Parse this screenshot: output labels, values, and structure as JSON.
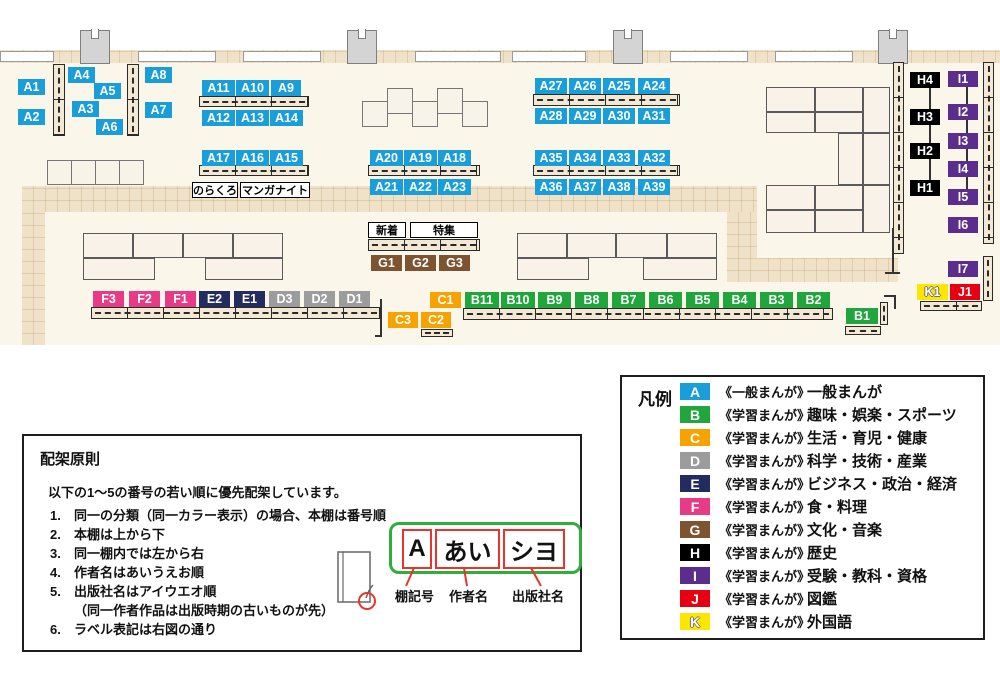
{
  "palette": {
    "A": {
      "bg": "#1a9ed9",
      "fg": "#ffffff"
    },
    "B": {
      "bg": "#21a63d",
      "fg": "#ffffff"
    },
    "C": {
      "bg": "#f6a200",
      "fg": "#ffffff"
    },
    "D": {
      "bg": "#9c9c9c",
      "fg": "#ffffff"
    },
    "E": {
      "bg": "#222c5e",
      "fg": "#ffffff"
    },
    "F": {
      "bg": "#e73b85",
      "fg": "#ffffff"
    },
    "G": {
      "bg": "#7d5330",
      "fg": "#ffffff"
    },
    "H": {
      "bg": "#000000",
      "fg": "#ffffff"
    },
    "I": {
      "bg": "#5b2d8d",
      "fg": "#ffffff"
    },
    "J": {
      "bg": "#e60012",
      "fg": "#ffffff"
    },
    "K": {
      "bg": "#ffe600",
      "fg": "#ffffff"
    }
  },
  "map": {
    "shelf_labels": [
      {
        "t": "A1",
        "c": "A",
        "x": 18,
        "y": 79,
        "w": 27
      },
      {
        "t": "A2",
        "c": "A",
        "x": 18,
        "y": 109,
        "w": 27
      },
      {
        "t": "A4",
        "c": "A",
        "x": 68,
        "y": 67,
        "w": 27
      },
      {
        "t": "A5",
        "c": "A",
        "x": 94,
        "y": 83,
        "w": 27
      },
      {
        "t": "A3",
        "c": "A",
        "x": 72,
        "y": 101,
        "w": 27
      },
      {
        "t": "A6",
        "c": "A",
        "x": 96,
        "y": 119,
        "w": 27
      },
      {
        "t": "A8",
        "c": "A",
        "x": 145,
        "y": 67,
        "w": 27
      },
      {
        "t": "A7",
        "c": "A",
        "x": 145,
        "y": 102,
        "w": 27
      },
      {
        "t": "A11",
        "c": "A",
        "x": 202,
        "y": 80,
        "w": 33
      },
      {
        "t": "A10",
        "c": "A",
        "x": 236,
        "y": 80,
        "w": 33
      },
      {
        "t": "A9",
        "c": "A",
        "x": 271,
        "y": 80,
        "w": 30
      },
      {
        "t": "A12",
        "c": "A",
        "x": 202,
        "y": 110,
        "w": 33
      },
      {
        "t": "A13",
        "c": "A",
        "x": 236,
        "y": 110,
        "w": 33
      },
      {
        "t": "A14",
        "c": "A",
        "x": 270,
        "y": 110,
        "w": 33
      },
      {
        "t": "A17",
        "c": "A",
        "x": 202,
        "y": 150,
        "w": 33
      },
      {
        "t": "A16",
        "c": "A",
        "x": 236,
        "y": 150,
        "w": 33
      },
      {
        "t": "A15",
        "c": "A",
        "x": 270,
        "y": 150,
        "w": 33
      },
      {
        "t": "A20",
        "c": "A",
        "x": 370,
        "y": 150,
        "w": 33
      },
      {
        "t": "A19",
        "c": "A",
        "x": 404,
        "y": 150,
        "w": 33
      },
      {
        "t": "A18",
        "c": "A",
        "x": 438,
        "y": 150,
        "w": 33
      },
      {
        "t": "A21",
        "c": "A",
        "x": 370,
        "y": 179,
        "w": 33
      },
      {
        "t": "A22",
        "c": "A",
        "x": 404,
        "y": 179,
        "w": 33
      },
      {
        "t": "A23",
        "c": "A",
        "x": 438,
        "y": 179,
        "w": 33
      },
      {
        "t": "A27",
        "c": "A",
        "x": 535,
        "y": 78,
        "w": 32
      },
      {
        "t": "A26",
        "c": "A",
        "x": 569,
        "y": 78,
        "w": 32
      },
      {
        "t": "A25",
        "c": "A",
        "x": 603,
        "y": 78,
        "w": 32
      },
      {
        "t": "A24",
        "c": "A",
        "x": 638,
        "y": 78,
        "w": 32
      },
      {
        "t": "A28",
        "c": "A",
        "x": 535,
        "y": 108,
        "w": 32
      },
      {
        "t": "A29",
        "c": "A",
        "x": 569,
        "y": 108,
        "w": 32
      },
      {
        "t": "A30",
        "c": "A",
        "x": 603,
        "y": 108,
        "w": 32
      },
      {
        "t": "A31",
        "c": "A",
        "x": 638,
        "y": 108,
        "w": 32
      },
      {
        "t": "A35",
        "c": "A",
        "x": 535,
        "y": 150,
        "w": 32
      },
      {
        "t": "A34",
        "c": "A",
        "x": 569,
        "y": 150,
        "w": 32
      },
      {
        "t": "A33",
        "c": "A",
        "x": 603,
        "y": 150,
        "w": 32
      },
      {
        "t": "A32",
        "c": "A",
        "x": 638,
        "y": 150,
        "w": 32
      },
      {
        "t": "A36",
        "c": "A",
        "x": 535,
        "y": 179,
        "w": 32
      },
      {
        "t": "A37",
        "c": "A",
        "x": 569,
        "y": 179,
        "w": 32
      },
      {
        "t": "A38",
        "c": "A",
        "x": 603,
        "y": 179,
        "w": 32
      },
      {
        "t": "A39",
        "c": "A",
        "x": 638,
        "y": 179,
        "w": 32
      },
      {
        "t": "G1",
        "c": "G",
        "x": 371,
        "y": 255,
        "w": 31
      },
      {
        "t": "G2",
        "c": "G",
        "x": 405,
        "y": 255,
        "w": 31
      },
      {
        "t": "G3",
        "c": "G",
        "x": 439,
        "y": 255,
        "w": 31
      },
      {
        "t": "F3",
        "c": "F",
        "x": 93,
        "y": 291,
        "w": 31
      },
      {
        "t": "F2",
        "c": "F",
        "x": 129,
        "y": 291,
        "w": 31
      },
      {
        "t": "F1",
        "c": "F",
        "x": 165,
        "y": 291,
        "w": 31
      },
      {
        "t": "E2",
        "c": "E",
        "x": 199,
        "y": 291,
        "w": 31
      },
      {
        "t": "E1",
        "c": "E",
        "x": 234,
        "y": 291,
        "w": 31
      },
      {
        "t": "D3",
        "c": "D",
        "x": 269,
        "y": 291,
        "w": 31
      },
      {
        "t": "D2",
        "c": "D",
        "x": 304,
        "y": 291,
        "w": 31
      },
      {
        "t": "D1",
        "c": "D",
        "x": 339,
        "y": 291,
        "w": 31
      },
      {
        "t": "C1",
        "c": "C",
        "x": 430,
        "y": 292,
        "w": 31
      },
      {
        "t": "C3",
        "c": "C",
        "x": 388,
        "y": 312,
        "w": 30
      },
      {
        "t": "C2",
        "c": "C",
        "x": 421,
        "y": 312,
        "w": 30
      },
      {
        "t": "B11",
        "c": "B",
        "x": 465,
        "y": 292,
        "w": 34
      },
      {
        "t": "B10",
        "c": "B",
        "x": 501,
        "y": 292,
        "w": 34
      },
      {
        "t": "B9",
        "c": "B",
        "x": 538,
        "y": 292,
        "w": 33
      },
      {
        "t": "B8",
        "c": "B",
        "x": 575,
        "y": 292,
        "w": 33
      },
      {
        "t": "B7",
        "c": "B",
        "x": 612,
        "y": 292,
        "w": 33
      },
      {
        "t": "B6",
        "c": "B",
        "x": 649,
        "y": 292,
        "w": 33
      },
      {
        "t": "B5",
        "c": "B",
        "x": 686,
        "y": 292,
        "w": 33
      },
      {
        "t": "B4",
        "c": "B",
        "x": 723,
        "y": 292,
        "w": 33
      },
      {
        "t": "B3",
        "c": "B",
        "x": 760,
        "y": 292,
        "w": 33
      },
      {
        "t": "B2",
        "c": "B",
        "x": 797,
        "y": 292,
        "w": 33
      },
      {
        "t": "B1",
        "c": "B",
        "x": 846,
        "y": 308,
        "w": 32
      },
      {
        "t": "H4",
        "c": "H",
        "x": 910,
        "y": 72,
        "w": 30
      },
      {
        "t": "H3",
        "c": "H",
        "x": 910,
        "y": 109,
        "w": 30
      },
      {
        "t": "H2",
        "c": "H",
        "x": 910,
        "y": 143,
        "w": 30
      },
      {
        "t": "H1",
        "c": "H",
        "x": 910,
        "y": 180,
        "w": 30
      },
      {
        "t": "I1",
        "c": "I",
        "x": 948,
        "y": 71,
        "w": 30
      },
      {
        "t": "I2",
        "c": "I",
        "x": 948,
        "y": 104,
        "w": 30
      },
      {
        "t": "I3",
        "c": "I",
        "x": 948,
        "y": 133,
        "w": 30
      },
      {
        "t": "I4",
        "c": "I",
        "x": 948,
        "y": 161,
        "w": 30
      },
      {
        "t": "I5",
        "c": "I",
        "x": 948,
        "y": 189,
        "w": 30
      },
      {
        "t": "I6",
        "c": "I",
        "x": 948,
        "y": 217,
        "w": 30
      },
      {
        "t": "I7",
        "c": "I",
        "x": 948,
        "y": 261,
        "w": 30
      },
      {
        "t": "K1",
        "c": "K",
        "x": 917,
        "y": 284,
        "w": 31
      },
      {
        "t": "J1",
        "c": "J",
        "x": 950,
        "y": 284,
        "w": 30
      }
    ],
    "signs": [
      {
        "t": "のらくろ",
        "x": 192,
        "y": 182,
        "w": 46
      },
      {
        "t": "マンガナイト",
        "x": 240,
        "y": 182,
        "w": 70
      },
      {
        "t": "新着",
        "x": 368,
        "y": 222,
        "w": 38
      },
      {
        "t": "特集",
        "x": 410,
        "y": 222,
        "w": 68
      }
    ]
  },
  "rules": {
    "title": "配架原則",
    "intro": "以下の1～5の番号の若い順に優先配架しています。",
    "items": [
      {
        "n": "1.",
        "t": "同一の分類（同一カラー表示）の場合、本棚は番号順"
      },
      {
        "n": "2.",
        "t": "本棚は上から下"
      },
      {
        "n": "3.",
        "t": "同一棚内では左から右"
      },
      {
        "n": "4.",
        "t": "作者名はあいうえお順"
      },
      {
        "n": "5.",
        "t": "出版社名はアイウエオ順",
        "note": "（同一作者作品は出版時期の古いものが先）"
      },
      {
        "n": "6.",
        "t": "ラベル表記は右図の通り"
      }
    ],
    "diagram": {
      "boxes": [
        "A",
        "あい",
        "シヨ"
      ],
      "captions": [
        "棚記号",
        "作者名",
        "出版社名"
      ]
    }
  },
  "legend": {
    "title": "凡例",
    "rows": [
      {
        "key": "A",
        "series": "《一般まんが》",
        "name": "一般まんが"
      },
      {
        "key": "B",
        "series": "《学習まんが》",
        "name": "趣味・娯楽・スポーツ"
      },
      {
        "key": "C",
        "series": "《学習まんが》",
        "name": "生活・育児・健康"
      },
      {
        "key": "D",
        "series": "《学習まんが》",
        "name": "科学・技術・産業"
      },
      {
        "key": "E",
        "series": "《学習まんが》",
        "name": "ビジネス・政治・経済"
      },
      {
        "key": "F",
        "series": "《学習まんが》",
        "name": "食・料理"
      },
      {
        "key": "G",
        "series": "《学習まんが》",
        "name": "文化・音楽"
      },
      {
        "key": "H",
        "series": "《学習まんが》",
        "name": "歴史"
      },
      {
        "key": "I",
        "series": "《学習まんが》",
        "name": "受験・教科・資格"
      },
      {
        "key": "J",
        "series": "《学習まんが》",
        "name": "図鑑"
      },
      {
        "key": "K",
        "series": "《学習まんが》",
        "name": "外国語"
      }
    ]
  }
}
